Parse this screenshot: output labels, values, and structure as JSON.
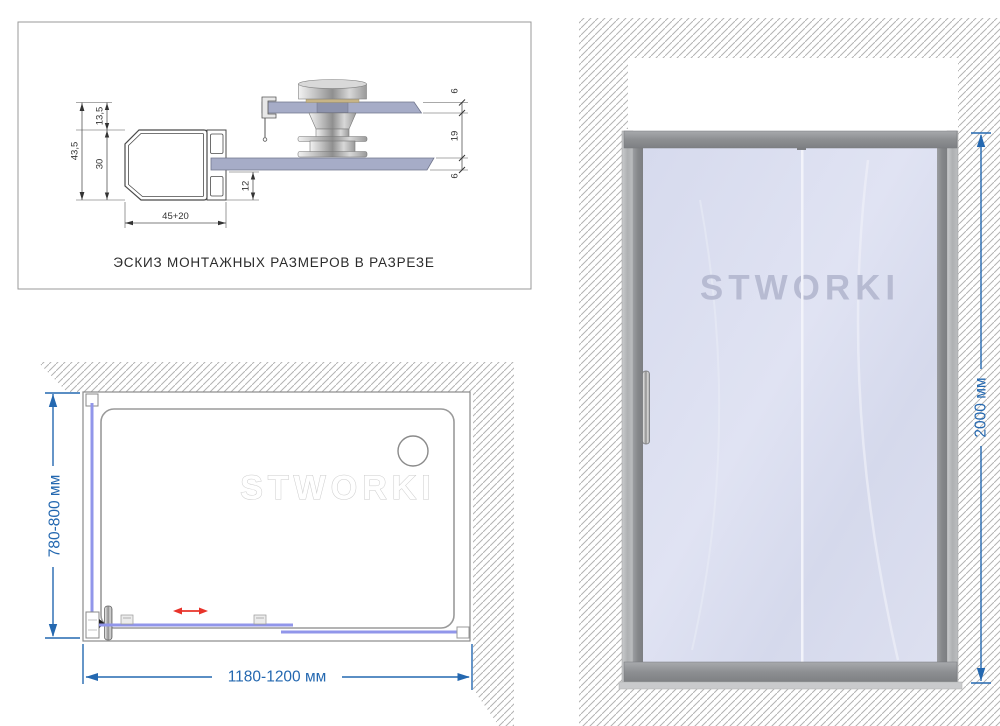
{
  "section": {
    "caption": "ЭСКИЗ МОНТАЖНЫХ РАЗМЕРОВ В РАЗРЕЗЕ",
    "dims": {
      "total_height": "43,5",
      "rail_offset": "13,5",
      "profile_height": "30",
      "glass_inset": "12",
      "profile_width": "45+20",
      "door_glass_thickness": "6",
      "panel_gap": "19",
      "fixed_glass_thickness": "6"
    }
  },
  "plan": {
    "watermark": "STWORKI",
    "depth_label": "780-800 мм",
    "width_label": "1180-1200 мм"
  },
  "front": {
    "watermark": "STWORKI",
    "height_label": "2000 мм"
  },
  "colors": {
    "dimension_blue": "#2468b0",
    "slide_arrow_red": "#e8332a",
    "hatch_gray": "#b3b3b3",
    "glass_tint": "#d9dcee",
    "frame_gray": "#8b8d90",
    "plan_glass_line": "#9196ea",
    "section_glass": "#a6acc7"
  }
}
